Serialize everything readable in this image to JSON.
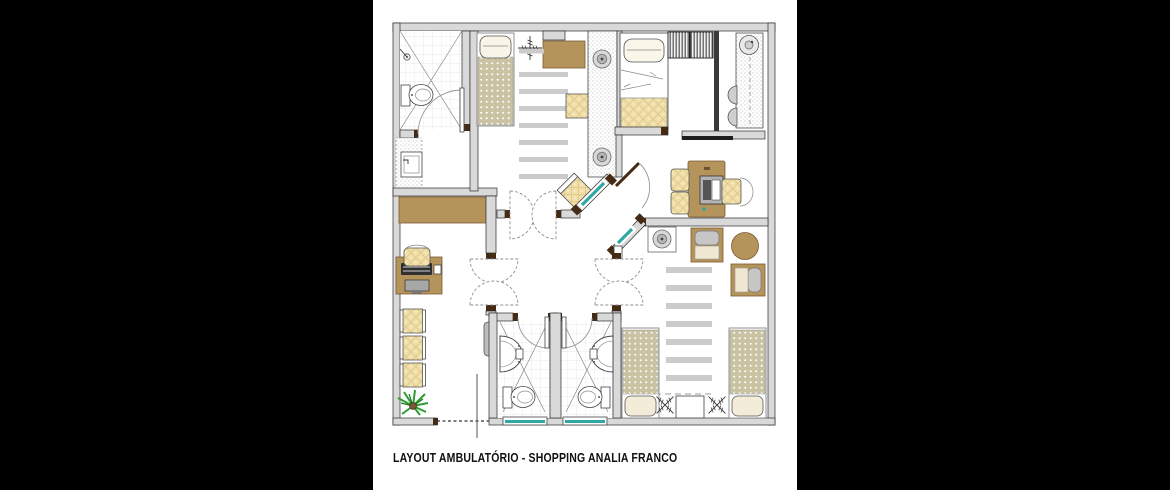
{
  "caption": "LAYOUT AMBULATÓRIO - SHOPPING ANALIA FRANCO",
  "colors": {
    "background": "#000000",
    "paper": "#ffffff",
    "wall_fill": "#d9d9d9",
    "wall_edge": "#2a2a2a",
    "wood": "#b5945c",
    "wood_edge": "#7a5a31",
    "wood_dark": "#452a14",
    "upholstery": "#f0dfa8",
    "upholstery_line": "#d3b879",
    "mattress": "#cac3a3",
    "stripe": "#cbcbcb",
    "glass": "#2fa8a4",
    "metal": "#cfcfcf",
    "plant": "#2e9b33",
    "caption": "#111111"
  },
  "plan": {
    "type": "floor-plan",
    "rooms": [
      "bathroom-top-left",
      "linen-closet",
      "reception",
      "treatment-area",
      "bedroom",
      "kitchenette",
      "office",
      "central-hall",
      "wc-1",
      "wc-2",
      "observation-room"
    ],
    "furniture": [
      "shower",
      "toilet",
      "wash-basin",
      "reception-counter",
      "computer-desk",
      "keyboard",
      "monitor",
      "desk-chair",
      "waiting-chairs",
      "plant",
      "exam-bed",
      "ceiling-light-symbol",
      "side-table",
      "guest-chair",
      "round-stools",
      "bed",
      "wardrobe",
      "kitchen-counter",
      "round-sink",
      "office-desk",
      "office-chairs",
      "armchairs",
      "round-table",
      "observation-beds",
      "nightstand",
      "floor-stripes",
      "double-swing-doors",
      "glazed-partitions",
      "drinking-fountain"
    ]
  }
}
